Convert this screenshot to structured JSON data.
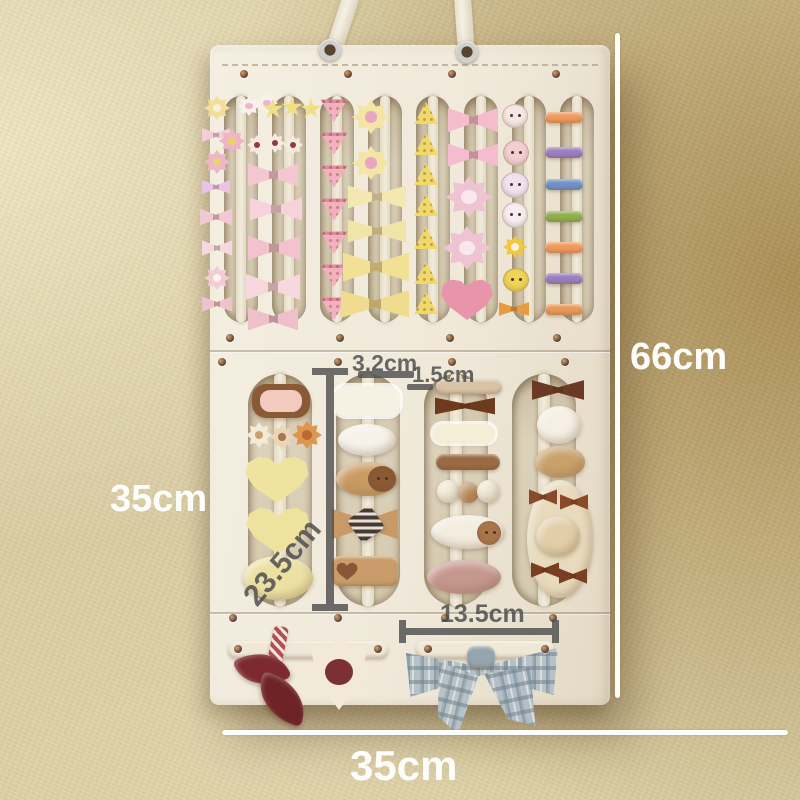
{
  "annotations": {
    "height": "66cm",
    "side_width": "35cm",
    "bottom_width": "35cm",
    "slat_width": "3.2cm",
    "slat_gap": "1.5cm",
    "slot_length": "23.5cm",
    "bottom_slot_width": "13.5cm"
  },
  "palette": {
    "wall_light": "#ece2c0",
    "wall_dark": "#ae9258",
    "felt": "#f1ebdd",
    "recess": "#d3c7ac",
    "rivet": "#6e4a33",
    "annotation_dark": "#4f4f4f",
    "annotation_light": "#ffffff",
    "rainbow_clip_colors": [
      "#ef9a5d",
      "#9b7fc2",
      "#6f93c8",
      "#8fb04e",
      "#ef9a5d",
      "#9b7fc2",
      "#e8995a"
    ]
  },
  "organizer": {
    "slot_groups": [
      {
        "count": 8,
        "x0": 224,
        "step": 48,
        "w": 34,
        "y": 96,
        "h": 226,
        "strap": 10
      },
      {
        "count": 4,
        "x0": 248,
        "step": 88,
        "w": 64,
        "y": 374,
        "h": 232,
        "strap": 12
      }
    ],
    "grommets": [
      [
        330,
        50
      ],
      [
        467,
        52
      ]
    ],
    "rivets": [
      [
        244,
        74
      ],
      [
        348,
        74
      ],
      [
        452,
        74
      ],
      [
        556,
        74
      ],
      [
        230,
        338
      ],
      [
        340,
        338
      ],
      [
        450,
        338
      ],
      [
        557,
        338
      ],
      [
        222,
        362
      ],
      [
        338,
        362
      ],
      [
        452,
        362
      ],
      [
        565,
        362
      ],
      [
        233,
        618
      ],
      [
        338,
        618
      ],
      [
        445,
        618
      ],
      [
        553,
        618
      ],
      [
        238,
        649
      ],
      [
        378,
        649
      ],
      [
        428,
        649
      ],
      [
        545,
        649
      ]
    ],
    "clips": [
      {
        "t": "flower",
        "x": 204,
        "y": 96,
        "w": 26,
        "h": 24,
        "c": "#f2de96",
        "c2": "#f8efd8"
      },
      {
        "t": "bow",
        "x": 202,
        "y": 126,
        "w": 28,
        "h": 18,
        "c": "#f5cdd9"
      },
      {
        "t": "flower",
        "x": 204,
        "y": 150,
        "w": 26,
        "h": 24,
        "c": "#efb6c8",
        "c2": "#ecd276"
      },
      {
        "t": "bow",
        "x": 202,
        "y": 178,
        "w": 28,
        "h": 18,
        "c": "#eac4e4"
      },
      {
        "t": "bow",
        "x": 200,
        "y": 206,
        "w": 32,
        "h": 22,
        "c": "#f2c9d3"
      },
      {
        "t": "bow",
        "x": 202,
        "y": 238,
        "w": 30,
        "h": 20,
        "c": "#f6d8df"
      },
      {
        "t": "flower",
        "x": 204,
        "y": 266,
        "w": 26,
        "h": 24,
        "c": "#f2ccd6",
        "c2": "#faf3ee"
      },
      {
        "t": "bow",
        "x": 202,
        "y": 294,
        "w": 30,
        "h": 20,
        "c": "#f0c2ce"
      },
      {
        "t": "flower",
        "x": 238,
        "y": 96,
        "w": 22,
        "h": 20,
        "c": "#f8f1ec",
        "c2": "#eeb7c6"
      },
      {
        "t": "flower",
        "x": 256,
        "y": 93,
        "w": 22,
        "h": 20,
        "c": "#f8f1ec",
        "c2": "#eeb7c6"
      },
      {
        "t": "star",
        "x": 262,
        "y": 98,
        "w": 22,
        "h": 22,
        "c": "#efe088"
      },
      {
        "t": "star",
        "x": 281,
        "y": 96,
        "w": 22,
        "h": 22,
        "c": "#efe088"
      },
      {
        "t": "star",
        "x": 300,
        "y": 98,
        "w": 22,
        "h": 22,
        "c": "#efe088"
      },
      {
        "t": "flower",
        "x": 219,
        "y": 129,
        "w": 26,
        "h": 24,
        "c": "#f0b4c7",
        "c2": "#e8d36a"
      },
      {
        "t": "flower",
        "x": 247,
        "y": 135,
        "w": 20,
        "h": 20,
        "c": "#f5ecdf",
        "c2": "#8e3a4a"
      },
      {
        "t": "flower",
        "x": 265,
        "y": 133,
        "w": 20,
        "h": 20,
        "c": "#f5ecdf",
        "c2": "#8e3a4a"
      },
      {
        "t": "flower",
        "x": 283,
        "y": 135,
        "w": 20,
        "h": 20,
        "c": "#f5ecdf",
        "c2": "#8e3a4a"
      },
      {
        "t": "bow",
        "x": 248,
        "y": 160,
        "w": 50,
        "h": 30,
        "c": "#f3c6d2"
      },
      {
        "t": "bow",
        "x": 250,
        "y": 194,
        "w": 52,
        "h": 30,
        "c": "#f6d3db"
      },
      {
        "t": "bow",
        "x": 248,
        "y": 232,
        "w": 52,
        "h": 32,
        "c": "#f2c3cf"
      },
      {
        "t": "bow",
        "x": 246,
        "y": 270,
        "w": 54,
        "h": 34,
        "c": "#f6d8de"
      },
      {
        "t": "bow",
        "x": 248,
        "y": 304,
        "w": 50,
        "h": 30,
        "c": "#f0bfcc"
      },
      {
        "t": "tri",
        "x": 320,
        "y": 98,
        "w": 28,
        "h": 24,
        "c": "#f3b1c0"
      },
      {
        "t": "tri",
        "x": 320,
        "y": 131,
        "w": 28,
        "h": 24,
        "c": "#f3b1c0"
      },
      {
        "t": "tri",
        "x": 320,
        "y": 164,
        "w": 28,
        "h": 24,
        "c": "#f3b1c0"
      },
      {
        "t": "tri",
        "x": 320,
        "y": 197,
        "w": 28,
        "h": 24,
        "c": "#f3b1c0"
      },
      {
        "t": "tri",
        "x": 320,
        "y": 230,
        "w": 28,
        "h": 24,
        "c": "#f3b1c0"
      },
      {
        "t": "tri",
        "x": 320,
        "y": 263,
        "w": 28,
        "h": 24,
        "c": "#f3b1c0"
      },
      {
        "t": "tri",
        "x": 320,
        "y": 296,
        "w": 28,
        "h": 24,
        "c": "#f3b1c0"
      },
      {
        "t": "flower",
        "x": 352,
        "y": 100,
        "w": 38,
        "h": 34,
        "c": "#f2e5a5",
        "c2": "#e8a7c0"
      },
      {
        "t": "flower",
        "x": 352,
        "y": 146,
        "w": 38,
        "h": 34,
        "c": "#f2e5a5",
        "c2": "#e8a7c0"
      },
      {
        "t": "bow",
        "x": 348,
        "y": 182,
        "w": 58,
        "h": 30,
        "c": "#f3e8b0"
      },
      {
        "t": "bow",
        "x": 348,
        "y": 216,
        "w": 58,
        "h": 30,
        "c": "#f1e4a8"
      },
      {
        "t": "bow",
        "x": 343,
        "y": 248,
        "w": 66,
        "h": 38,
        "c": "#f2e094"
      },
      {
        "t": "bow",
        "x": 341,
        "y": 286,
        "w": 68,
        "h": 36,
        "c": "#f0dc8e"
      },
      {
        "t": "wedge",
        "x": 414,
        "y": 102,
        "w": 24,
        "h": 22,
        "c": "#f0d969"
      },
      {
        "t": "wedge",
        "x": 414,
        "y": 133,
        "w": 24,
        "h": 22,
        "c": "#f0d969"
      },
      {
        "t": "wedge",
        "x": 414,
        "y": 163,
        "w": 24,
        "h": 22,
        "c": "#f0d969"
      },
      {
        "t": "wedge",
        "x": 414,
        "y": 194,
        "w": 24,
        "h": 22,
        "c": "#f0d969"
      },
      {
        "t": "wedge",
        "x": 414,
        "y": 227,
        "w": 24,
        "h": 22,
        "c": "#f0d969"
      },
      {
        "t": "wedge",
        "x": 414,
        "y": 262,
        "w": 24,
        "h": 22,
        "c": "#f0d969"
      },
      {
        "t": "wedge",
        "x": 414,
        "y": 292,
        "w": 24,
        "h": 22,
        "c": "#f0d969"
      },
      {
        "t": "bow",
        "x": 448,
        "y": 104,
        "w": 50,
        "h": 32,
        "c": "#f4bccc"
      },
      {
        "t": "bow",
        "x": 448,
        "y": 140,
        "w": 50,
        "h": 30,
        "c": "#f4bccc"
      },
      {
        "t": "flower",
        "x": 446,
        "y": 176,
        "w": 46,
        "h": 42,
        "c": "#eec3d2",
        "c2": "#f8e8ee"
      },
      {
        "t": "flower",
        "x": 443,
        "y": 226,
        "w": 48,
        "h": 44,
        "c": "#eec3d2",
        "c2": "#f8e8ee"
      },
      {
        "t": "heart",
        "x": 440,
        "y": 278,
        "w": 54,
        "h": 42,
        "c": "#e895ac"
      },
      {
        "t": "face",
        "x": 502,
        "y": 104,
        "w": 24,
        "h": 22,
        "c": "#f7e8e8"
      },
      {
        "t": "face",
        "x": 503,
        "y": 140,
        "w": 24,
        "h": 24,
        "c": "#f3cfd4"
      },
      {
        "t": "face",
        "x": 501,
        "y": 172,
        "w": 26,
        "h": 24,
        "c": "#efe3ef"
      },
      {
        "t": "face",
        "x": 502,
        "y": 202,
        "w": 24,
        "h": 24,
        "c": "#f6eef0"
      },
      {
        "t": "flower",
        "x": 503,
        "y": 236,
        "w": 24,
        "h": 22,
        "c": "#f0c840",
        "c2": "#fbf3d8"
      },
      {
        "t": "face",
        "x": 503,
        "y": 268,
        "w": 24,
        "h": 22,
        "c": "#f0d457"
      },
      {
        "t": "bow",
        "x": 499,
        "y": 300,
        "w": 30,
        "h": 18,
        "c": "#e89b3f"
      },
      {
        "t": "bar",
        "x": 545,
        "y": 112,
        "w": 38,
        "h": 11,
        "c": "#ef9a5d"
      },
      {
        "t": "bar",
        "x": 545,
        "y": 147,
        "w": 38,
        "h": 11,
        "c": "#9b7fc2"
      },
      {
        "t": "bar",
        "x": 545,
        "y": 179,
        "w": 38,
        "h": 11,
        "c": "#6f93c8"
      },
      {
        "t": "bar",
        "x": 545,
        "y": 211,
        "w": 38,
        "h": 11,
        "c": "#8fb04e"
      },
      {
        "t": "bar",
        "x": 545,
        "y": 242,
        "w": 38,
        "h": 11,
        "c": "#ef9a5d"
      },
      {
        "t": "bar",
        "x": 545,
        "y": 273,
        "w": 38,
        "h": 11,
        "c": "#9b7fc2"
      },
      {
        "t": "bar",
        "x": 545,
        "y": 304,
        "w": 38,
        "h": 11,
        "c": "#e8995a"
      },
      {
        "t": "bear",
        "x": 252,
        "y": 384,
        "w": 58,
        "h": 34,
        "c": "#8a5a35",
        "c2": "#f2cabe"
      },
      {
        "t": "flower",
        "x": 246,
        "y": 422,
        "w": 26,
        "h": 26,
        "c": "#f3ead8",
        "c2": "#caa26a"
      },
      {
        "t": "flower",
        "x": 270,
        "y": 424,
        "w": 24,
        "h": 26,
        "c": "#e9d6b8",
        "c2": "#a8764a"
      },
      {
        "t": "flower",
        "x": 292,
        "y": 421,
        "w": 30,
        "h": 28,
        "c": "#e0954f",
        "c2": "#b86a32"
      },
      {
        "t": "heart",
        "x": 244,
        "y": 455,
        "w": 66,
        "h": 48,
        "c": "#f0e3a0"
      },
      {
        "t": "heart",
        "x": 245,
        "y": 506,
        "w": 66,
        "h": 48,
        "c": "#efe29e"
      },
      {
        "t": "pom",
        "x": 243,
        "y": 556,
        "w": 70,
        "h": 44,
        "c": "#ece0a2"
      },
      {
        "t": "label",
        "x": 334,
        "y": 386,
        "w": 66,
        "h": 30,
        "c": "#f7f1e3",
        "text": "Bear♡Love"
      },
      {
        "t": "pom",
        "x": 338,
        "y": 424,
        "w": 58,
        "h": 32,
        "c": "#f6f1ea"
      },
      {
        "t": "pom",
        "x": 336,
        "y": 462,
        "w": 62,
        "h": 34,
        "c": "#c99a62"
      },
      {
        "t": "face",
        "x": 368,
        "y": 466,
        "w": 26,
        "h": 24,
        "c": "#8a5a35"
      },
      {
        "t": "bow",
        "x": 332,
        "y": 504,
        "w": 66,
        "h": 40,
        "c": "#c89a68"
      },
      {
        "t": "cord",
        "x": 352,
        "y": 510,
        "w": 28,
        "h": 28,
        "c": "#4a3a2e",
        "r": -35
      },
      {
        "t": "bar",
        "x": 332,
        "y": 556,
        "w": 66,
        "h": 30,
        "c": "#c99c6a"
      },
      {
        "t": "heart",
        "x": 336,
        "y": 562,
        "w": 22,
        "h": 18,
        "c": "#8a5638"
      },
      {
        "t": "bar",
        "x": 436,
        "y": 379,
        "w": 66,
        "h": 15,
        "c": "#d8c3a4"
      },
      {
        "t": "bow",
        "x": 435,
        "y": 395,
        "w": 60,
        "h": 22,
        "c": "#6e3a1e"
      },
      {
        "t": "label",
        "x": 433,
        "y": 424,
        "w": 62,
        "h": 19,
        "c": "#f4eed6",
        "text": "Smile☺"
      },
      {
        "t": "bar",
        "x": 436,
        "y": 454,
        "w": 64,
        "h": 16,
        "c": "#9a6a44"
      },
      {
        "t": "pom",
        "x": 437,
        "y": 480,
        "w": 23,
        "h": 23,
        "c": "#f2ead8"
      },
      {
        "t": "pom",
        "x": 458,
        "y": 482,
        "w": 21,
        "h": 21,
        "c": "#b98a58"
      },
      {
        "t": "pom",
        "x": 477,
        "y": 480,
        "w": 23,
        "h": 23,
        "c": "#efe7d6"
      },
      {
        "t": "pom",
        "x": 431,
        "y": 515,
        "w": 74,
        "h": 34,
        "c": "#f3ede0"
      },
      {
        "t": "face",
        "x": 477,
        "y": 521,
        "w": 22,
        "h": 22,
        "c": "#a8764a"
      },
      {
        "t": "pom",
        "x": 427,
        "y": 560,
        "w": 74,
        "h": 34,
        "c": "#c5978e"
      },
      {
        "t": "bow",
        "x": 532,
        "y": 377,
        "w": 52,
        "h": 26,
        "c": "#6a3a22"
      },
      {
        "t": "pom",
        "x": 537,
        "y": 406,
        "w": 44,
        "h": 38,
        "c": "#f5efe4"
      },
      {
        "t": "pom",
        "x": 535,
        "y": 446,
        "w": 50,
        "h": 32,
        "c": "#c9a06a"
      },
      {
        "t": "pom",
        "x": 527,
        "y": 480,
        "w": 66,
        "h": 118,
        "c": "#e8dabc"
      },
      {
        "t": "bow",
        "x": 529,
        "y": 487,
        "w": 28,
        "h": 20,
        "c": "#8a4a2a"
      },
      {
        "t": "bow",
        "x": 560,
        "y": 492,
        "w": 28,
        "h": 20,
        "c": "#8a4a2a"
      },
      {
        "t": "pom",
        "x": 536,
        "y": 516,
        "w": 44,
        "h": 40,
        "c": "#e2cfa8"
      },
      {
        "t": "bow",
        "x": 531,
        "y": 560,
        "w": 28,
        "h": 20,
        "c": "#7a3f22"
      },
      {
        "t": "bow",
        "x": 559,
        "y": 566,
        "w": 28,
        "h": 20,
        "c": "#7a3f22"
      },
      {
        "t": "bar",
        "x": 228,
        "y": 641,
        "w": 160,
        "h": 17,
        "c": "#efe8d8"
      },
      {
        "t": "bar",
        "x": 416,
        "y": 641,
        "w": 138,
        "h": 17,
        "c": "#efe8d8"
      },
      {
        "t": "cord",
        "x": 270,
        "y": 626,
        "w": 15,
        "h": 42,
        "c": "#b05050",
        "r": 12
      },
      {
        "t": "leaf",
        "x": 238,
        "y": 650,
        "w": 48,
        "h": 38,
        "c": "#7c2a2e",
        "r": -24
      },
      {
        "t": "leaf",
        "x": 256,
        "y": 678,
        "w": 52,
        "h": 42,
        "c": "#6e2327",
        "r": 18
      },
      {
        "t": "flower",
        "x": 298,
        "y": 634,
        "w": 82,
        "h": 76,
        "c": "#f2e9d8",
        "c2": "#7c3034"
      },
      {
        "t": "plaidbow",
        "x": 406,
        "y": 638,
        "w": 152,
        "h": 60,
        "c": "#b6c2c8"
      },
      {
        "t": "plaidtail",
        "x": 430,
        "y": 666,
        "w": 42,
        "h": 66,
        "c": "#b6c2c8",
        "r": 14
      },
      {
        "t": "plaidtail",
        "x": 490,
        "y": 668,
        "w": 46,
        "h": 62,
        "c": "#b3bfc6",
        "r": -12
      },
      {
        "t": "bar",
        "x": 467,
        "y": 646,
        "w": 28,
        "h": 22,
        "c": "#94a5ad"
      }
    ]
  }
}
